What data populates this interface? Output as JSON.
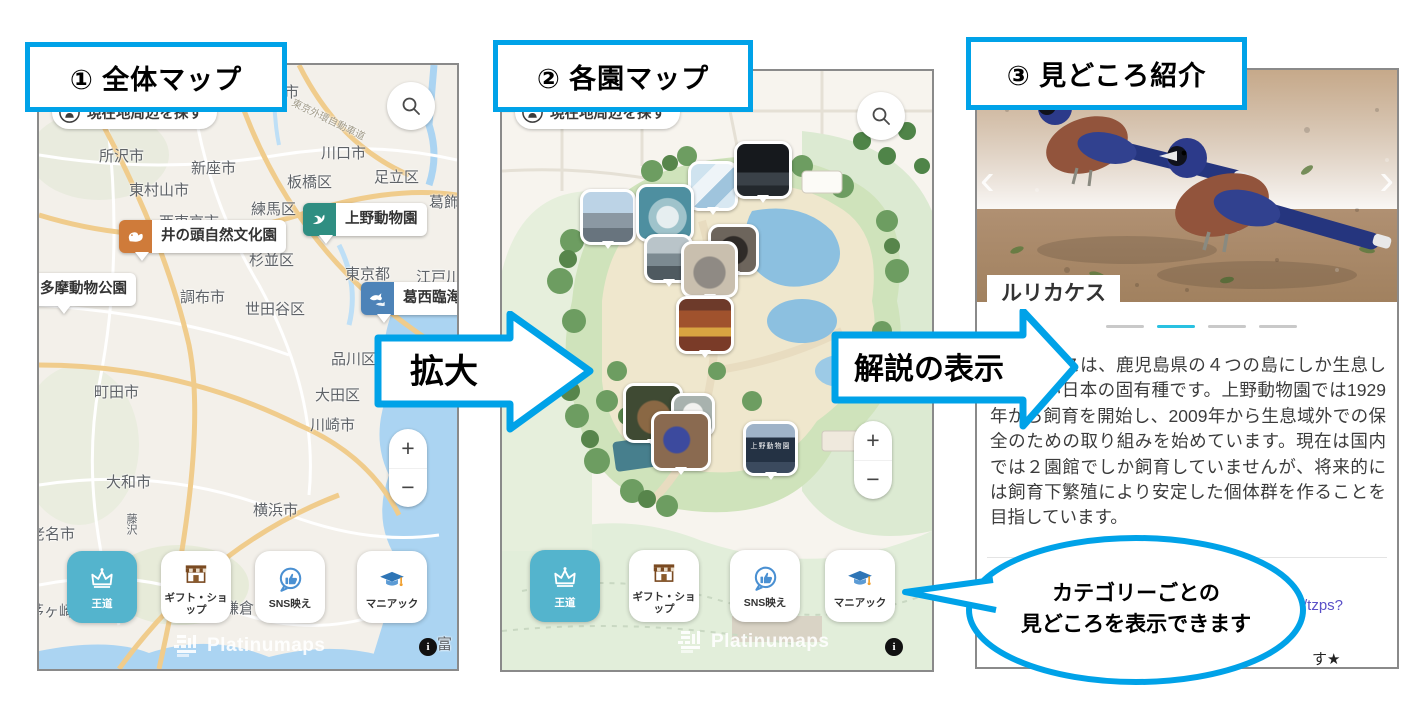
{
  "colors": {
    "accent": "#00a2e8",
    "active_category": "#54b4cd",
    "link": "#5a50c8",
    "carousel_active": "#29c1e1"
  },
  "steps": {
    "one": "① 全体マップ",
    "two": "② 各園マップ",
    "three": "③ 見どころ紹介"
  },
  "arrows": {
    "zoom_in": "拡大",
    "show_description": "解説の表示"
  },
  "callout": {
    "line1": "カテゴリーごとの",
    "line2": "見どころを表示できます"
  },
  "map_ui": {
    "locate_button": "現在地周辺を探す",
    "zoom_in": "+",
    "zoom_out": "−",
    "watermark": "Platinumaps",
    "info": "i"
  },
  "categories": [
    {
      "id": "royal",
      "label": "王道",
      "icon": "crown",
      "active": true
    },
    {
      "id": "gift",
      "label": "ギフト・ショップ",
      "icon": "shop",
      "active": false
    },
    {
      "id": "sns",
      "label": "SNS映え",
      "icon": "sns",
      "active": false
    },
    {
      "id": "maniac",
      "label": "マニアック",
      "icon": "maniac",
      "active": false
    }
  ],
  "overview_map": {
    "cities": [
      {
        "name": "市",
        "x": 245,
        "y": 16
      },
      {
        "name": "東京外環自動車道",
        "x": 250,
        "y": 46,
        "small": true,
        "rotate": 26
      },
      {
        "name": "所沢市",
        "x": 60,
        "y": 80
      },
      {
        "name": "新座市",
        "x": 152,
        "y": 92
      },
      {
        "name": "東村山市",
        "x": 90,
        "y": 114
      },
      {
        "name": "川口市",
        "x": 282,
        "y": 77
      },
      {
        "name": "板橋区",
        "x": 248,
        "y": 106
      },
      {
        "name": "足立区",
        "x": 335,
        "y": 101
      },
      {
        "name": "練馬区",
        "x": 212,
        "y": 133
      },
      {
        "name": "葛飾区",
        "x": 390,
        "y": 126
      },
      {
        "name": "西東京市",
        "x": 120,
        "y": 146
      },
      {
        "name": "杉並区",
        "x": 210,
        "y": 184
      },
      {
        "name": "東京都",
        "x": 306,
        "y": 198
      },
      {
        "name": "江戸川区",
        "x": 377,
        "y": 201
      },
      {
        "name": "調布市",
        "x": 141,
        "y": 221
      },
      {
        "name": "世田谷区",
        "x": 206,
        "y": 233
      },
      {
        "name": "品川区",
        "x": 292,
        "y": 283
      },
      {
        "name": "町田市",
        "x": 55,
        "y": 316
      },
      {
        "name": "大田区",
        "x": 276,
        "y": 319
      },
      {
        "name": "川崎市",
        "x": 271,
        "y": 349
      },
      {
        "name": "大和市",
        "x": 67,
        "y": 406
      },
      {
        "name": "横浜市",
        "x": 214,
        "y": 434
      },
      {
        "name": "海老名市",
        "x": -24,
        "y": 458
      },
      {
        "name": "藤沢",
        "x": 84,
        "y": 448,
        "vertical": true
      },
      {
        "name": "茅ヶ崎",
        "x": -10,
        "y": 535
      },
      {
        "name": "鎌倉",
        "x": 185,
        "y": 532
      },
      {
        "name": "富",
        "x": 398,
        "y": 568
      }
    ],
    "poi_markers": [
      {
        "id": "tama-zoo",
        "name": "多摩動物公園",
        "icon": null,
        "color": null,
        "x": -8,
        "y": 208
      },
      {
        "id": "inokashira",
        "name": "井の頭自然文化園",
        "icon": "squirrel",
        "color": "#cf7b3a",
        "x": 80,
        "y": 155
      },
      {
        "id": "ueno-zoo",
        "name": "上野動物園",
        "icon": "swan",
        "color": "#2f8e82",
        "x": 264,
        "y": 138
      },
      {
        "id": "kasai",
        "name": "葛西臨海水族園",
        "icon": "fish",
        "color": "#4d83b8",
        "x": 322,
        "y": 217
      }
    ]
  },
  "zoo_map": {
    "gate_sign": "上野動物園",
    "photo_markers": [
      {
        "id": "mosaic-wall",
        "x": 186,
        "y": 90,
        "size": 44
      },
      {
        "id": "night-house",
        "x": 232,
        "y": 70,
        "size": 52
      },
      {
        "id": "west-gate",
        "x": 78,
        "y": 118,
        "size": 50
      },
      {
        "id": "polar-bear",
        "x": 134,
        "y": 113,
        "size": 52
      },
      {
        "id": "sealion-rock",
        "x": 142,
        "y": 163,
        "size": 43
      },
      {
        "id": "bear",
        "x": 206,
        "y": 153,
        "size": 45
      },
      {
        "id": "elephant",
        "x": 179,
        "y": 170,
        "size": 51
      },
      {
        "id": "temple",
        "x": 174,
        "y": 225,
        "size": 52
      },
      {
        "id": "deer",
        "x": 121,
        "y": 312,
        "size": 54
      },
      {
        "id": "whitebird",
        "x": 169,
        "y": 322,
        "size": 38
      },
      {
        "id": "jay",
        "x": 149,
        "y": 340,
        "size": 54
      },
      {
        "id": "gate",
        "x": 241,
        "y": 350,
        "size": 49,
        "sign": true
      }
    ]
  },
  "detail": {
    "title": "ルリカケス",
    "description": "ルリカケスは、鹿児島県の４つの島にしか生息していない日本の固有種です。上野動物園では1929年から飼育を開始し、2009年から生息域外での保全のための取り組みを始めています。現在は国内では２園館でしか飼育していませんが、将来的には飼育下繁殖により安定した個体群を作ることを目指しています。",
    "link_fragment": "/tzps?",
    "text_fragment": "す★",
    "carousel": {
      "count": 4,
      "active": 1,
      "prev": "‹",
      "next": "›"
    }
  }
}
